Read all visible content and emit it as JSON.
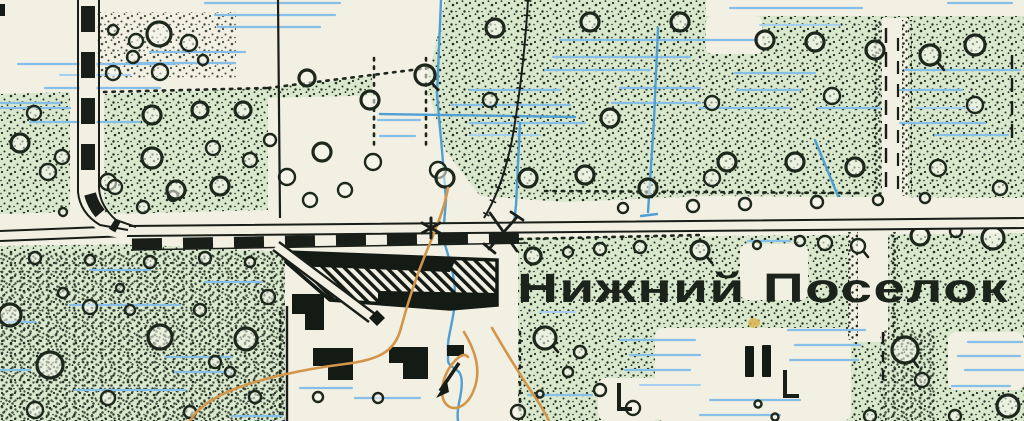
{
  "map": {
    "settlement_label": "Нижний Поселок",
    "colors": {
      "paper": "#f2efe3",
      "vegetation_green": "#d9e8cd",
      "marsh_blue": "#86bfe8",
      "stream_blue": "#4f9fd4",
      "contour_orange": "#d2954a",
      "ink_black": "#191f18"
    },
    "symbols": {
      "bush_circle": "scrub/bush circle symbol",
      "stipple_dot": "scrub stipple dots",
      "marsh_dash": "horizontal marsh dashes",
      "drainage_ditch": "blue ditch line",
      "main_road": "double-line road",
      "track_dashes": "dashed track alongside road",
      "village_block": "hatched built-up block",
      "building_square": "black building square",
      "star_landmark": "star point symbol",
      "windmill": "crossed windmill symbol",
      "flow_arrow": "stream flow arrow",
      "boundary_dash": "dashed boundary line",
      "contour": "orange contour line"
    }
  }
}
